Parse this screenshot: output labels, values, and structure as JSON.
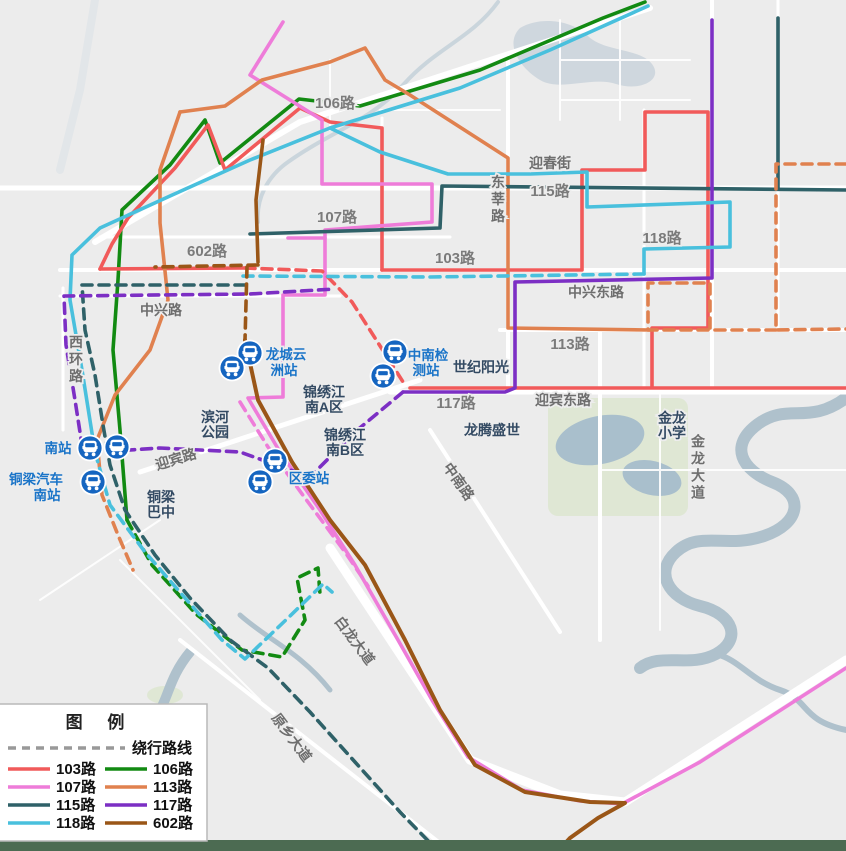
{
  "legend": {
    "title": "图 例",
    "detour_label": "绕行路线"
  },
  "routes": [
    {
      "label": "103路",
      "color": "#f15a5a"
    },
    {
      "label": "106路",
      "color": "#128a12"
    },
    {
      "label": "107路",
      "color": "#ee7cd9"
    },
    {
      "label": "113路",
      "color": "#e0814f"
    },
    {
      "label": "115路",
      "color": "#2f6168"
    },
    {
      "label": "117路",
      "color": "#7c2fc4"
    },
    {
      "label": "118路",
      "color": "#49c0dd"
    },
    {
      "label": "602路",
      "color": "#9a5617"
    }
  ],
  "road_labels": [
    "迎春街",
    "东莘路",
    "中兴路",
    "西环路",
    "迎宾路",
    "中兴东路",
    "迎宾东路",
    "中南路",
    "金龙大道",
    "白龙大道",
    "原乡大道"
  ],
  "area_labels": [
    "滨河",
    "公园",
    "铜梁",
    "巴中",
    "锦绣江",
    "南A区",
    "锦绣江",
    "南B区",
    "龙腾盛世",
    "世纪阳光",
    "金龙",
    "小学"
  ],
  "station_labels": [
    "南站",
    "铜梁汽车",
    "南站",
    "龙城云",
    "洲站",
    "中南检",
    "测站",
    "区委站"
  ],
  "stations": [
    {
      "name": "南站"
    },
    {
      "name": "南站"
    },
    {
      "name": "铜梁汽车南站"
    },
    {
      "name": "龙城云洲站"
    },
    {
      "name": "龙城云洲站"
    },
    {
      "name": "中南检测站"
    },
    {
      "name": "中南检测站"
    },
    {
      "name": "区委站"
    },
    {
      "name": "区委站"
    }
  ],
  "colors": {
    "background": "#ececec",
    "water": "#afc1cc",
    "park": "#dfe7d4",
    "greenbelt": "#4c6b52",
    "detour_gray": "#999999",
    "station_marker": "#1565c0",
    "station_label": "#1a74c8",
    "area_label": "#334a63"
  }
}
